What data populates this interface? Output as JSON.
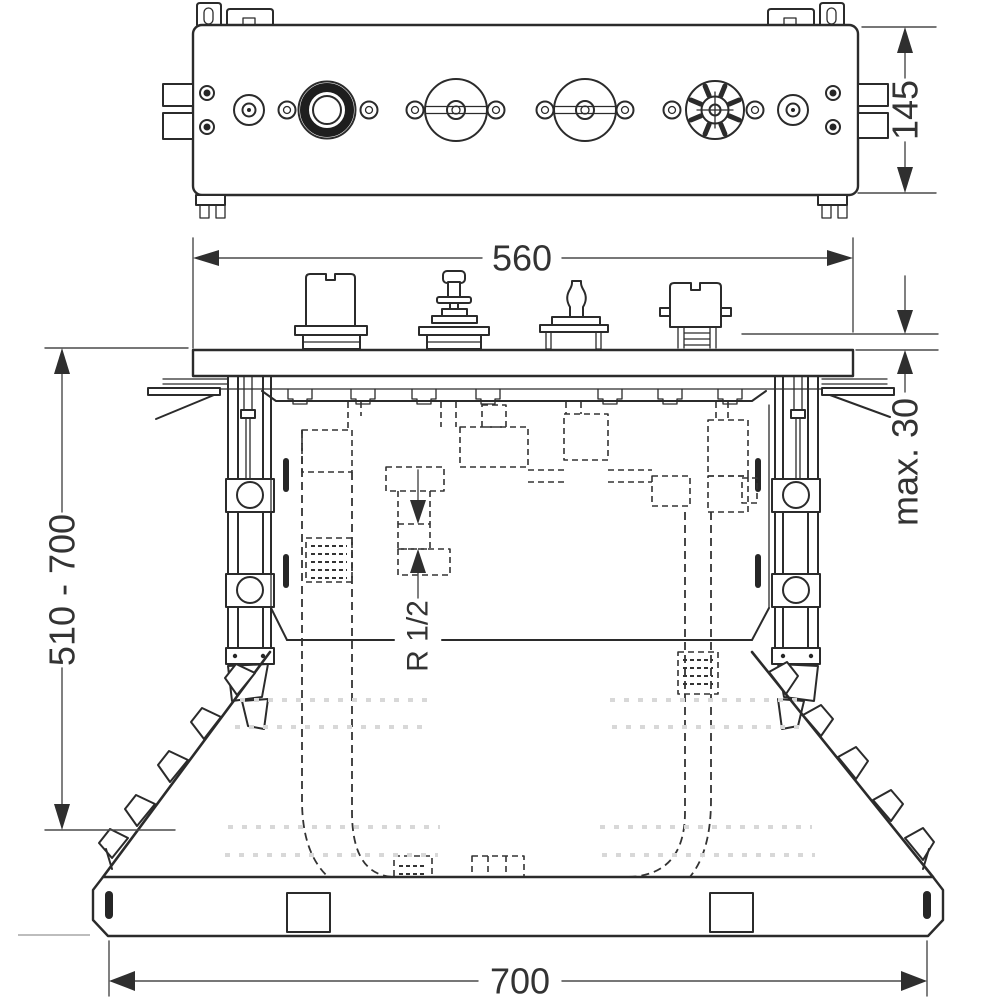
{
  "drawing": {
    "type": "technical-installation-drawing",
    "views": {
      "top": "top view of built-in housing",
      "front": "front installation view"
    },
    "dimensions": {
      "housing_height": "145",
      "housing_width": "560",
      "tile_thickness_max": "max. 30",
      "installation_height_range": "510 - 700",
      "pipe_thread": "R 1/2",
      "base_width": "700"
    },
    "colors": {
      "line": "#2b2b2b",
      "dimension": "#4a4a4a",
      "ghost": "#d8d8d8",
      "background": "#ffffff"
    }
  }
}
